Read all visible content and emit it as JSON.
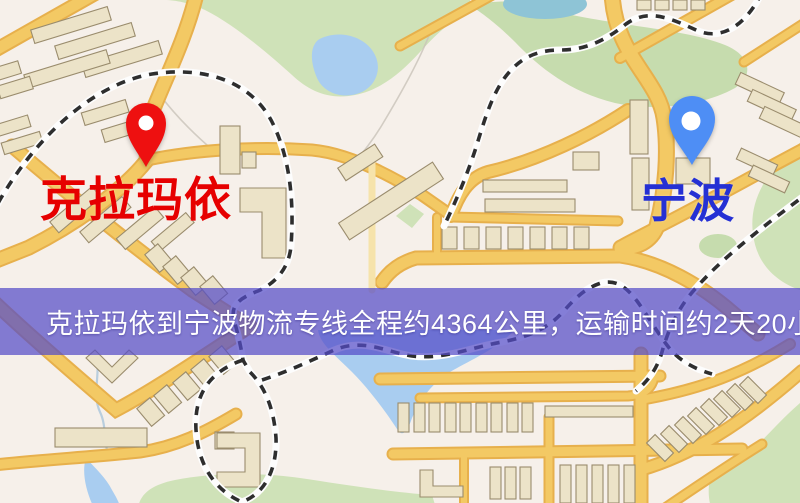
{
  "banner": {
    "text": "克拉玛依到宁波物流专线全程约4364公里，运输时间约2天20小时.",
    "background": "rgba(84,76,200,0.72)",
    "color": "#ffffff"
  },
  "markers": {
    "origin": {
      "label": "克拉玛依",
      "pin_color": "#ee1010",
      "pin_type": "red-map-pin",
      "label_color": "#e60000"
    },
    "destination": {
      "label": "宁波",
      "pin_color": "#4e8ef5",
      "pin_type": "blue-map-pin",
      "label_color": "#2530d4"
    }
  },
  "map_colors": {
    "background": "#f6f0ea",
    "road_fill": "#f3c964",
    "road_casing": "#e7b04c",
    "water": "#a9cdf0",
    "park": "#cfe2b8",
    "building": "#ece3c8",
    "railway": "#2e2e2e"
  }
}
